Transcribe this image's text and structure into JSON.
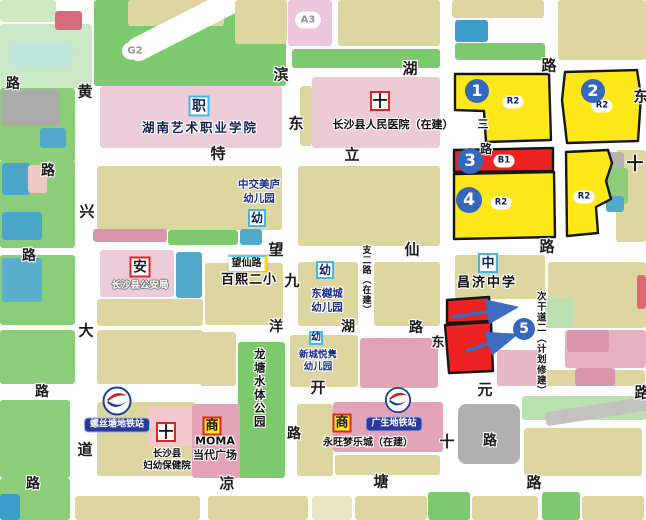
{
  "map": {
    "size": {
      "w": 646,
      "h": 520
    },
    "colors": {
      "road": "#ffffff",
      "zone_yellow": "#ffe81a",
      "zone_red": "#ee2222",
      "zone_border": "#161616",
      "marker_blue": "#3567bf",
      "metro_label_blue": "#2a3a9a",
      "badge_blue_border": "#45b6ea",
      "badge_red_border": "#e02222",
      "green_park": "#7dca6e",
      "tan_block": "#ddd6a0",
      "pink_campus": "#edccd9",
      "rose_commercial": "#e2a4b6"
    },
    "parcels_xywh_color_radius_rot": [
      [
        0,
        24,
        92,
        64,
        "#c9e9c6"
      ],
      [
        8,
        42,
        66,
        26,
        "#bfe7dc",
        13
      ],
      [
        0,
        0,
        56,
        22,
        "#cde9c1"
      ],
      [
        55,
        11,
        27,
        19,
        "#d66b7c"
      ],
      [
        94,
        0,
        192,
        86,
        "#7dca6e"
      ],
      [
        128,
        0,
        96,
        26,
        "#ddd6a0"
      ],
      [
        118,
        2,
        178,
        24,
        "#ffffff",
        12,
        -27
      ],
      [
        235,
        0,
        52,
        44,
        "#ddd6a0"
      ],
      [
        288,
        0,
        44,
        46,
        "#ecc6da"
      ],
      [
        338,
        0,
        102,
        46,
        "#ddd6a0"
      ],
      [
        452,
        0,
        92,
        18,
        "#ddd6a0"
      ],
      [
        455,
        20,
        33,
        22,
        "#3e9ecb"
      ],
      [
        558,
        0,
        88,
        60,
        "#ddd6a0"
      ],
      [
        292,
        49,
        148,
        19,
        "#7dca6e"
      ],
      [
        455,
        43,
        90,
        17,
        "#7dca6e"
      ],
      [
        0,
        88,
        75,
        74,
        "#8ccd7a"
      ],
      [
        2,
        90,
        58,
        36,
        "#ababa9"
      ],
      [
        40,
        128,
        26,
        20,
        "#51aac9"
      ],
      [
        100,
        86,
        182,
        62,
        "#edccd9"
      ],
      [
        300,
        86,
        12,
        60,
        "#ddd6a0"
      ],
      [
        312,
        77,
        128,
        71,
        "#edcbd4"
      ],
      [
        0,
        160,
        75,
        88,
        "#8ccd7a"
      ],
      [
        2,
        163,
        28,
        32,
        "#4ba7c9"
      ],
      [
        28,
        165,
        19,
        28,
        "#efc7c3"
      ],
      [
        2,
        212,
        40,
        28,
        "#4ba7c9"
      ],
      [
        97,
        166,
        185,
        64,
        "#ddd6a0"
      ],
      [
        93,
        229,
        74,
        13,
        "#d995ab"
      ],
      [
        168,
        230,
        70,
        15,
        "#7dca6e"
      ],
      [
        240,
        229,
        22,
        16,
        "#51aac9"
      ],
      [
        298,
        166,
        142,
        80,
        "#ddd6a0"
      ],
      [
        616,
        150,
        30,
        92,
        "#ddd6a0"
      ],
      [
        600,
        152,
        24,
        18,
        "#b4b4ae"
      ],
      [
        602,
        168,
        26,
        36,
        "#8ccd7a"
      ],
      [
        606,
        196,
        18,
        16,
        "#51aac9"
      ],
      [
        0,
        255,
        75,
        70,
        "#8ccd7a"
      ],
      [
        2,
        258,
        40,
        44,
        "#58aecb"
      ],
      [
        100,
        250,
        74,
        47,
        "#edccd9"
      ],
      [
        176,
        252,
        26,
        46,
        "#51aac9"
      ],
      [
        97,
        299,
        106,
        27,
        "#ddd6a0"
      ],
      [
        205,
        263,
        78,
        62,
        "#ddd6a0"
      ],
      [
        298,
        262,
        60,
        64,
        "#ddd6a0"
      ],
      [
        374,
        262,
        66,
        64,
        "#ddd6a0"
      ],
      [
        455,
        255,
        90,
        44,
        "#ddd6a0"
      ],
      [
        548,
        262,
        98,
        66,
        "#ddd6a0"
      ],
      [
        545,
        298,
        28,
        30,
        "#b9e0ae"
      ],
      [
        637,
        275,
        9,
        34,
        "#e06a74"
      ],
      [
        565,
        330,
        81,
        38,
        "#e6b0bf"
      ],
      [
        567,
        330,
        42,
        22,
        "#d995ab"
      ],
      [
        0,
        330,
        75,
        54,
        "#8ccd7a"
      ],
      [
        97,
        330,
        106,
        54,
        "#ddd6a0"
      ],
      [
        200,
        332,
        36,
        54,
        "#ddd6a0"
      ],
      [
        238,
        342,
        47,
        136,
        "#7dca6e"
      ],
      [
        290,
        335,
        68,
        52,
        "#ddd6a0"
      ],
      [
        360,
        338,
        78,
        50,
        "#e2a4b6"
      ],
      [
        497,
        350,
        48,
        36,
        "#e8b7c4"
      ],
      [
        545,
        370,
        100,
        16,
        "#ddd6a0"
      ],
      [
        575,
        368,
        40,
        18,
        "#d995ab"
      ],
      [
        0,
        400,
        70,
        78,
        "#8ccd7a"
      ],
      [
        97,
        402,
        98,
        74,
        "#ddd6a0"
      ],
      [
        148,
        408,
        47,
        38,
        "#f4c9ce"
      ],
      [
        192,
        404,
        48,
        74,
        "#e2a4b6"
      ],
      [
        297,
        404,
        36,
        72,
        "#ddd6a0"
      ],
      [
        333,
        402,
        110,
        50,
        "#e2a4b6"
      ],
      [
        335,
        455,
        105,
        20,
        "#ddd6a0"
      ],
      [
        458,
        404,
        62,
        60,
        "#b0b0ae",
        8
      ],
      [
        522,
        396,
        124,
        24,
        "#b9e0ae"
      ],
      [
        545,
        404,
        108,
        14,
        "#c2c2be",
        3,
        -9
      ],
      [
        524,
        428,
        118,
        48,
        "#ddd6a0"
      ],
      [
        0,
        478,
        70,
        42,
        "#8ccd7a"
      ],
      [
        0,
        494,
        20,
        26,
        "#3e9ecb"
      ],
      [
        75,
        496,
        125,
        24,
        "#ddd6a0"
      ],
      [
        208,
        496,
        100,
        24,
        "#ddd6a0"
      ],
      [
        312,
        496,
        40,
        24,
        "#e9e6c4"
      ],
      [
        355,
        496,
        72,
        24,
        "#ddd6a0"
      ],
      [
        428,
        492,
        42,
        28,
        "#7dca6e"
      ],
      [
        472,
        496,
        66,
        24,
        "#ddd6a0"
      ],
      [
        542,
        492,
        38,
        28,
        "#7dca6e"
      ],
      [
        582,
        496,
        62,
        24,
        "#ddd6a0"
      ]
    ],
    "zones": [
      {
        "id": "1",
        "fill": "#ffe81a",
        "points": "455,74 549,74 551,140 486,142 484,111 455,110"
      },
      {
        "id": "2",
        "fill": "#ffe81a",
        "points": "565,72 637,70 641,96 638,141 567,143 562,100"
      },
      {
        "id": "3",
        "fill": "#ee2222",
        "points": "454,150 553,148 553,171 454,172"
      },
      {
        "id": "4",
        "fill": "#ffe81a",
        "points": "454,174 554,172 555,237 454,239"
      },
      {
        "id": "5",
        "fill": "#ffe81a",
        "points": "566,152 608,150 612,163 606,181 611,199 596,207 598,233 567,236"
      },
      {
        "id": "redA",
        "fill": "#ee2222",
        "points": "447,300 489,297 491,321 447,323"
      },
      {
        "id": "redB",
        "fill": "#ee2222",
        "points": "445,325 491,322 493,371 449,373"
      }
    ],
    "zone_tags": [
      {
        "t": "R2",
        "x": 513,
        "y": 102
      },
      {
        "t": "R2",
        "x": 602,
        "y": 106
      },
      {
        "t": "B1",
        "x": 504,
        "y": 161
      },
      {
        "t": "R2",
        "x": 501,
        "y": 203
      },
      {
        "t": "R2",
        "x": 584,
        "y": 197
      }
    ],
    "numbers": [
      {
        "n": "1",
        "x": 477,
        "y": 91,
        "d": 24
      },
      {
        "n": "2",
        "x": 593,
        "y": 91,
        "d": 24
      },
      {
        "n": "3",
        "x": 470,
        "y": 161,
        "d": 26
      },
      {
        "n": "4",
        "x": 469,
        "y": 200,
        "d": 26
      },
      {
        "n": "5",
        "x": 524,
        "y": 329,
        "d": 22
      }
    ],
    "arrows": [
      [
        452,
        317,
        512,
        308
      ],
      [
        466,
        351,
        512,
        336
      ]
    ],
    "area_ovals": [
      {
        "t": "G2",
        "x": 135,
        "y": 51
      },
      {
        "t": "A3",
        "x": 308,
        "y": 20
      }
    ],
    "road_labels": [
      [
        "路",
        13,
        84,
        14
      ],
      [
        "黄",
        85,
        92,
        15
      ],
      [
        "滨",
        281,
        75,
        15
      ],
      [
        "湖",
        410,
        69,
        15
      ],
      [
        "路",
        549,
        66,
        15
      ],
      [
        "东",
        296,
        124,
        15
      ],
      [
        "东",
        641,
        97,
        15
      ],
      [
        "特",
        218,
        154,
        15
      ],
      [
        "立",
        352,
        155,
        15
      ],
      [
        "三",
        483,
        124,
        11
      ],
      [
        "路",
        486,
        149,
        12
      ],
      [
        "十",
        635,
        165,
        17
      ],
      [
        "路",
        48,
        171,
        14
      ],
      [
        "兴",
        87,
        212,
        15
      ],
      [
        "望",
        276,
        250,
        15
      ],
      [
        "仙",
        412,
        250,
        15
      ],
      [
        "路",
        547,
        247,
        15
      ],
      [
        "路",
        29,
        256,
        14
      ],
      [
        "九",
        292,
        281,
        15
      ],
      [
        "大",
        86,
        331,
        15
      ],
      [
        "洋",
        276,
        327,
        14
      ],
      [
        "湖",
        348,
        327,
        14
      ],
      [
        "路",
        416,
        328,
        14
      ],
      [
        "东",
        438,
        343,
        13
      ],
      [
        "路",
        42,
        392,
        14
      ],
      [
        "开",
        318,
        388,
        15
      ],
      [
        "元",
        485,
        390,
        15
      ],
      [
        "路",
        642,
        393,
        15
      ],
      [
        "道",
        85,
        450,
        15
      ],
      [
        "路",
        294,
        434,
        14
      ],
      [
        "十",
        447,
        442,
        15
      ],
      [
        "路",
        490,
        441,
        14
      ],
      [
        "路",
        33,
        484,
        14
      ],
      [
        "凉",
        227,
        484,
        15
      ],
      [
        "塘",
        381,
        482,
        15
      ],
      [
        "路",
        534,
        483,
        15
      ]
    ],
    "vertical_road_labels": [
      {
        "t": "支二路（在建）",
        "x": 365,
        "y": 245,
        "fs": 9,
        "ls": 1
      },
      {
        "t": "次干道二（计划修建）",
        "x": 540,
        "y": 291,
        "fs": 9.5,
        "ls": 1
      },
      {
        "t": "龙塘水体公园",
        "x": 259,
        "y": 348,
        "fs": 11.5,
        "ls": 2
      }
    ],
    "facilities": [
      {
        "t": "湖南艺术职业学院",
        "x": 200,
        "y": 128,
        "fs": 12.5,
        "c": "#10214f",
        "ls": 2,
        "halo": "light"
      },
      {
        "t": "长沙县人民医院（在建）",
        "x": 393,
        "y": 125,
        "fs": 11,
        "c": "#0d0d0d",
        "ls": 0,
        "halo": "light"
      },
      {
        "t": "中交美庐\n幼儿园",
        "x": 259,
        "y": 192,
        "fs": 10.5,
        "c": "#1c2f80",
        "ls": 0,
        "halo": "light"
      },
      {
        "t": "百熙二小",
        "x": 249,
        "y": 281,
        "fs": 13,
        "c": "#0d0d0d",
        "ls": 1,
        "halo": "light"
      },
      {
        "t": "东樾城\n幼儿园",
        "x": 327,
        "y": 301,
        "fs": 10.5,
        "c": "#1c2f80",
        "ls": 0,
        "halo": "light"
      },
      {
        "t": "新城悦隽\n幼儿园",
        "x": 318,
        "y": 362,
        "fs": 9.5,
        "c": "#1c2f80",
        "ls": 0,
        "halo": "light"
      },
      {
        "t": "昌济中学",
        "x": 487,
        "y": 284,
        "fs": 13,
        "c": "#0d0d0d",
        "ls": 2,
        "halo": "light"
      },
      {
        "t": "长沙县公安局",
        "x": 140,
        "y": 286,
        "fs": 9.5,
        "c": "#ffffff",
        "ls": 0,
        "halo": "dark"
      },
      {
        "t": "长沙县\n妇幼保健院",
        "x": 167,
        "y": 461,
        "fs": 9.5,
        "c": "#0d0d0d",
        "ls": 0,
        "halo": "light"
      },
      {
        "t": "MOMA\n当代广场",
        "x": 215,
        "y": 449,
        "fs": 11,
        "c": "#0d0d0d",
        "ls": 0,
        "halo": "light"
      },
      {
        "t": "永旺梦乐城（在建）",
        "x": 368,
        "y": 443,
        "fs": 10,
        "c": "#0d0d0d",
        "ls": 0,
        "halo": "light"
      }
    ],
    "badges": [
      {
        "t": "职",
        "x": 199,
        "y": 106,
        "s": 21,
        "bc": "#45b6ea",
        "bg": "#ffffff",
        "c": "#14255c",
        "fs": 14
      },
      {
        "t": "幼",
        "x": 257,
        "y": 218,
        "s": 18,
        "bc": "#45b6ea",
        "bg": "#ffffff",
        "c": "#14255c",
        "fs": 12
      },
      {
        "t": "幼",
        "x": 325,
        "y": 270,
        "s": 18,
        "bc": "#45b6ea",
        "bg": "#ffffff",
        "c": "#14255c",
        "fs": 12
      },
      {
        "t": "幼",
        "x": 316,
        "y": 338,
        "s": 14,
        "bc": "#45b6ea",
        "bg": "#ffffff",
        "c": "#14255c",
        "fs": 10
      },
      {
        "t": "中",
        "x": 488,
        "y": 263,
        "s": 20,
        "bc": "#45b6ea",
        "bg": "#ffffff",
        "c": "#14255c",
        "fs": 13
      },
      {
        "t": "安",
        "x": 140,
        "y": 267,
        "s": 21,
        "bc": "#e02222",
        "bg": "#ffffff",
        "c": "#1b1b1b",
        "fs": 14
      },
      {
        "t": "商",
        "x": 212,
        "y": 426,
        "s": 19,
        "bc": "#e02222",
        "bg": "#ffe81a",
        "c": "#1b1b1b",
        "fs": 13
      },
      {
        "t": "商",
        "x": 342,
        "y": 423,
        "s": 19,
        "bc": "#e02222",
        "bg": "#ffe81a",
        "c": "#1b1b1b",
        "fs": 13
      },
      {
        "t": "十",
        "x": 380,
        "y": 101,
        "s": 20,
        "bc": "#e02222",
        "bg": "#ffffff",
        "c": "#0d0d0d",
        "fs": 15
      },
      {
        "t": "十",
        "x": 166,
        "y": 432,
        "s": 20,
        "bc": "#e02222",
        "bg": "#ffffff",
        "c": "#0d0d0d",
        "fs": 15
      }
    ],
    "stations": [
      {
        "label": "螺丝塘地铁站",
        "logo_x": 117,
        "logo_y": 403,
        "logo_s": 30,
        "label_x": 117,
        "label_y": 425,
        "fs": 9
      },
      {
        "label": "广生地铁站",
        "logo_x": 398,
        "logo_y": 402,
        "logo_s": 27,
        "label_x": 394,
        "label_y": 424,
        "fs": 9
      }
    ],
    "highlight_label": {
      "t": "望仙路",
      "x": 248,
      "y": 263,
      "fs": 10
    }
  }
}
